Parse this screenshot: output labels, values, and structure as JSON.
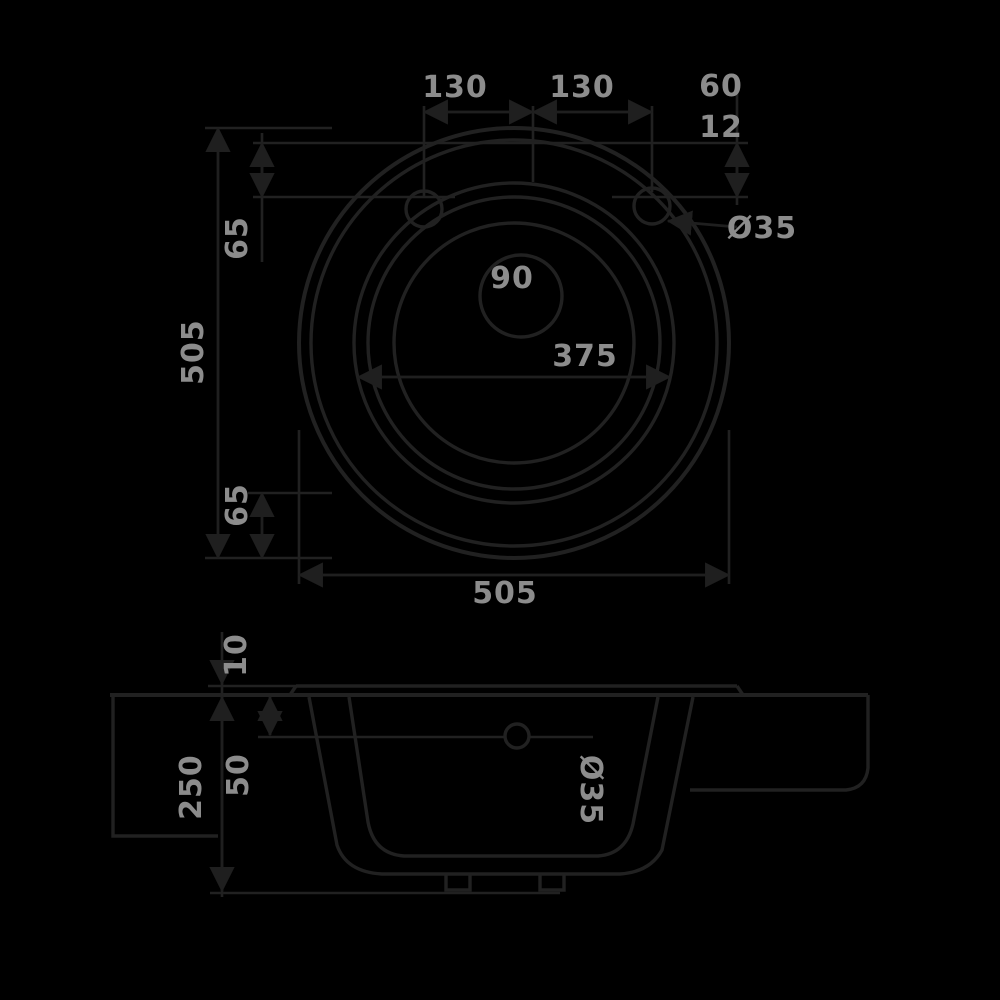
{
  "drawing": {
    "type": "technical-drawing",
    "subject": "round-sink",
    "colors": {
      "background": "#000000",
      "line": "#212121",
      "label": "#8c8c8c"
    },
    "plan": {
      "hole_spacing_left": "130",
      "hole_spacing_right": "130",
      "edge_gap_upper": "60",
      "edge_gap_lower": "12",
      "faucet_hole_diameter": "Ø35",
      "drain_diameter": "90",
      "bowl_diameter": "375",
      "overall_height": "505",
      "overall_width": "505",
      "rim_offset_top": "65",
      "rim_offset_bottom": "65"
    },
    "section": {
      "rim_height": "10",
      "overflow_depth": "50",
      "total_height": "250",
      "overflow_diameter": "Ø35"
    }
  }
}
